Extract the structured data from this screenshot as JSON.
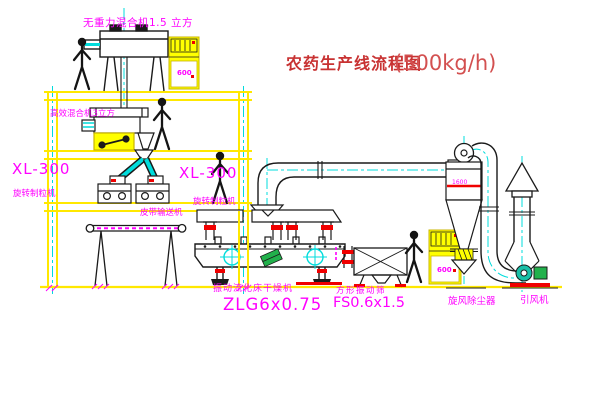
{
  "title": {
    "name_cn": "农药生产线流程图",
    "capacity": "(500kg/h)"
  },
  "labels": {
    "top_mixer": "无重力混合机1.5 立方",
    "high_mixer": "高效混合机3立方",
    "xl300_left": "XL-300",
    "granulator_left": "旋转制粒机",
    "xl300_right": "XL-300",
    "granulator_right": "旋转制粒机",
    "belt_conveyor": "皮带输送机",
    "dryer": "振动流化床干燥机",
    "dryer_model": "ZLG6x0.75",
    "sieve": "方形振动筛",
    "sieve_model": "FS0.6x1.5",
    "cyclone": "旋风除尘器",
    "fan": "引风机",
    "cyclone_dim": "1600",
    "cabinet_text": "600"
  },
  "colors": {
    "structure_yellow": "#FFE800",
    "fill_yellow": "#FFFF00",
    "centerline_cyan": "#00DCDC",
    "label_magenta": "#FF00FF",
    "title_red": "#C83232",
    "accent_red": "#F00000",
    "motor_green": "#22B14C",
    "line_black": "#1A1A1A"
  }
}
